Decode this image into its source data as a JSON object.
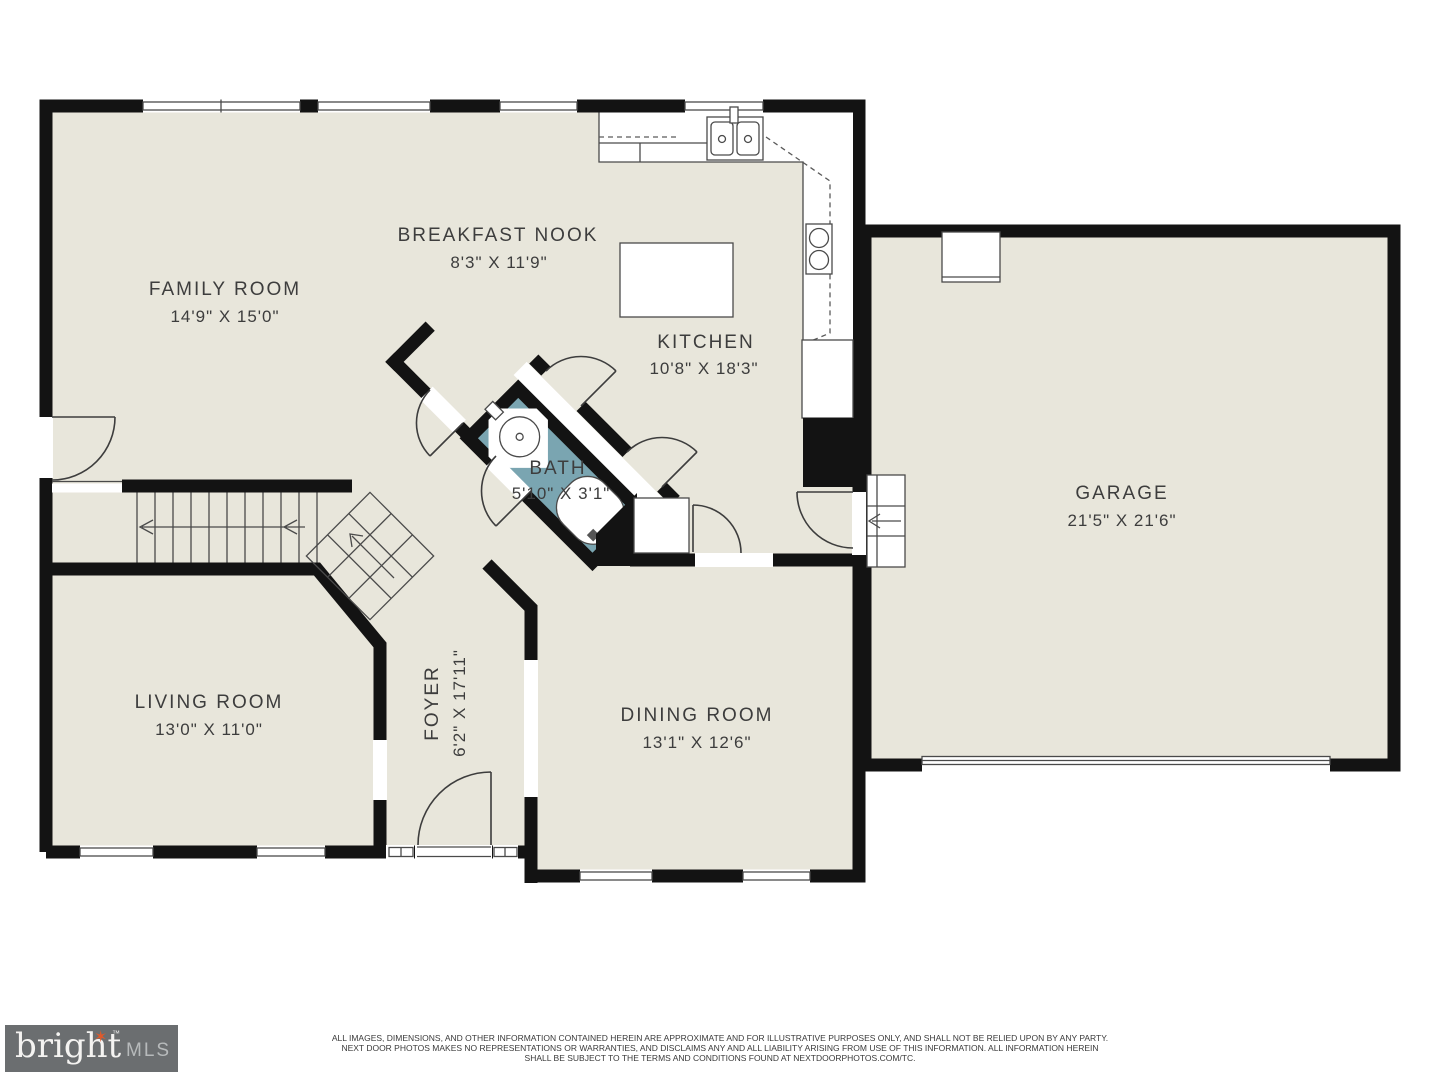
{
  "plan": {
    "rooms": {
      "family": {
        "name": "FAMILY ROOM",
        "dims": "14'9\" X 15'0\""
      },
      "nook": {
        "name": "BREAKFAST NOOK",
        "dims": "8'3\" X 11'9\""
      },
      "kitchen": {
        "name": "KITCHEN",
        "dims": "10'8\" X 18'3\""
      },
      "bath": {
        "name": "BATH",
        "dims": "5'10\" X 3'1\""
      },
      "garage": {
        "name": "GARAGE",
        "dims": "21'5\" X 21'6\""
      },
      "living": {
        "name": "LIVING ROOM",
        "dims": "13'0\" X 11'0\""
      },
      "foyer": {
        "name": "FOYER",
        "dims": "6'2\" X 17'11\""
      },
      "dining": {
        "name": "DINING ROOM",
        "dims": "13'1\" X 12'6\""
      }
    },
    "colors": {
      "floor": "#e8e6db",
      "wall": "#131313",
      "bath_floor": "#7aa5b1",
      "line": "#4a4a4a"
    }
  },
  "footer": {
    "logo": {
      "brand": "bright",
      "suffix": "MLS",
      "tm": "™",
      "accent": "#e0592a",
      "background": "#6b6e70"
    },
    "disclaimer": {
      "line1": "ALL IMAGES, DIMENSIONS, AND OTHER INFORMATION CONTAINED HEREIN ARE APPROXIMATE AND FOR ILLUSTRATIVE PURPOSES ONLY, AND SHALL NOT BE RELIED UPON BY ANY PARTY.",
      "line2": "NEXT DOOR PHOTOS MAKES NO REPRESENTATIONS OR WARRANTIES, AND DISCLAIMS ANY AND ALL LIABILITY ARISING FROM USE OF THIS INFORMATION. ALL INFORMATION HEREIN",
      "line3": "SHALL BE SUBJECT TO THE TERMS AND CONDITIONS FOUND AT NEXTDOORPHOTOS.COM/TC."
    }
  }
}
